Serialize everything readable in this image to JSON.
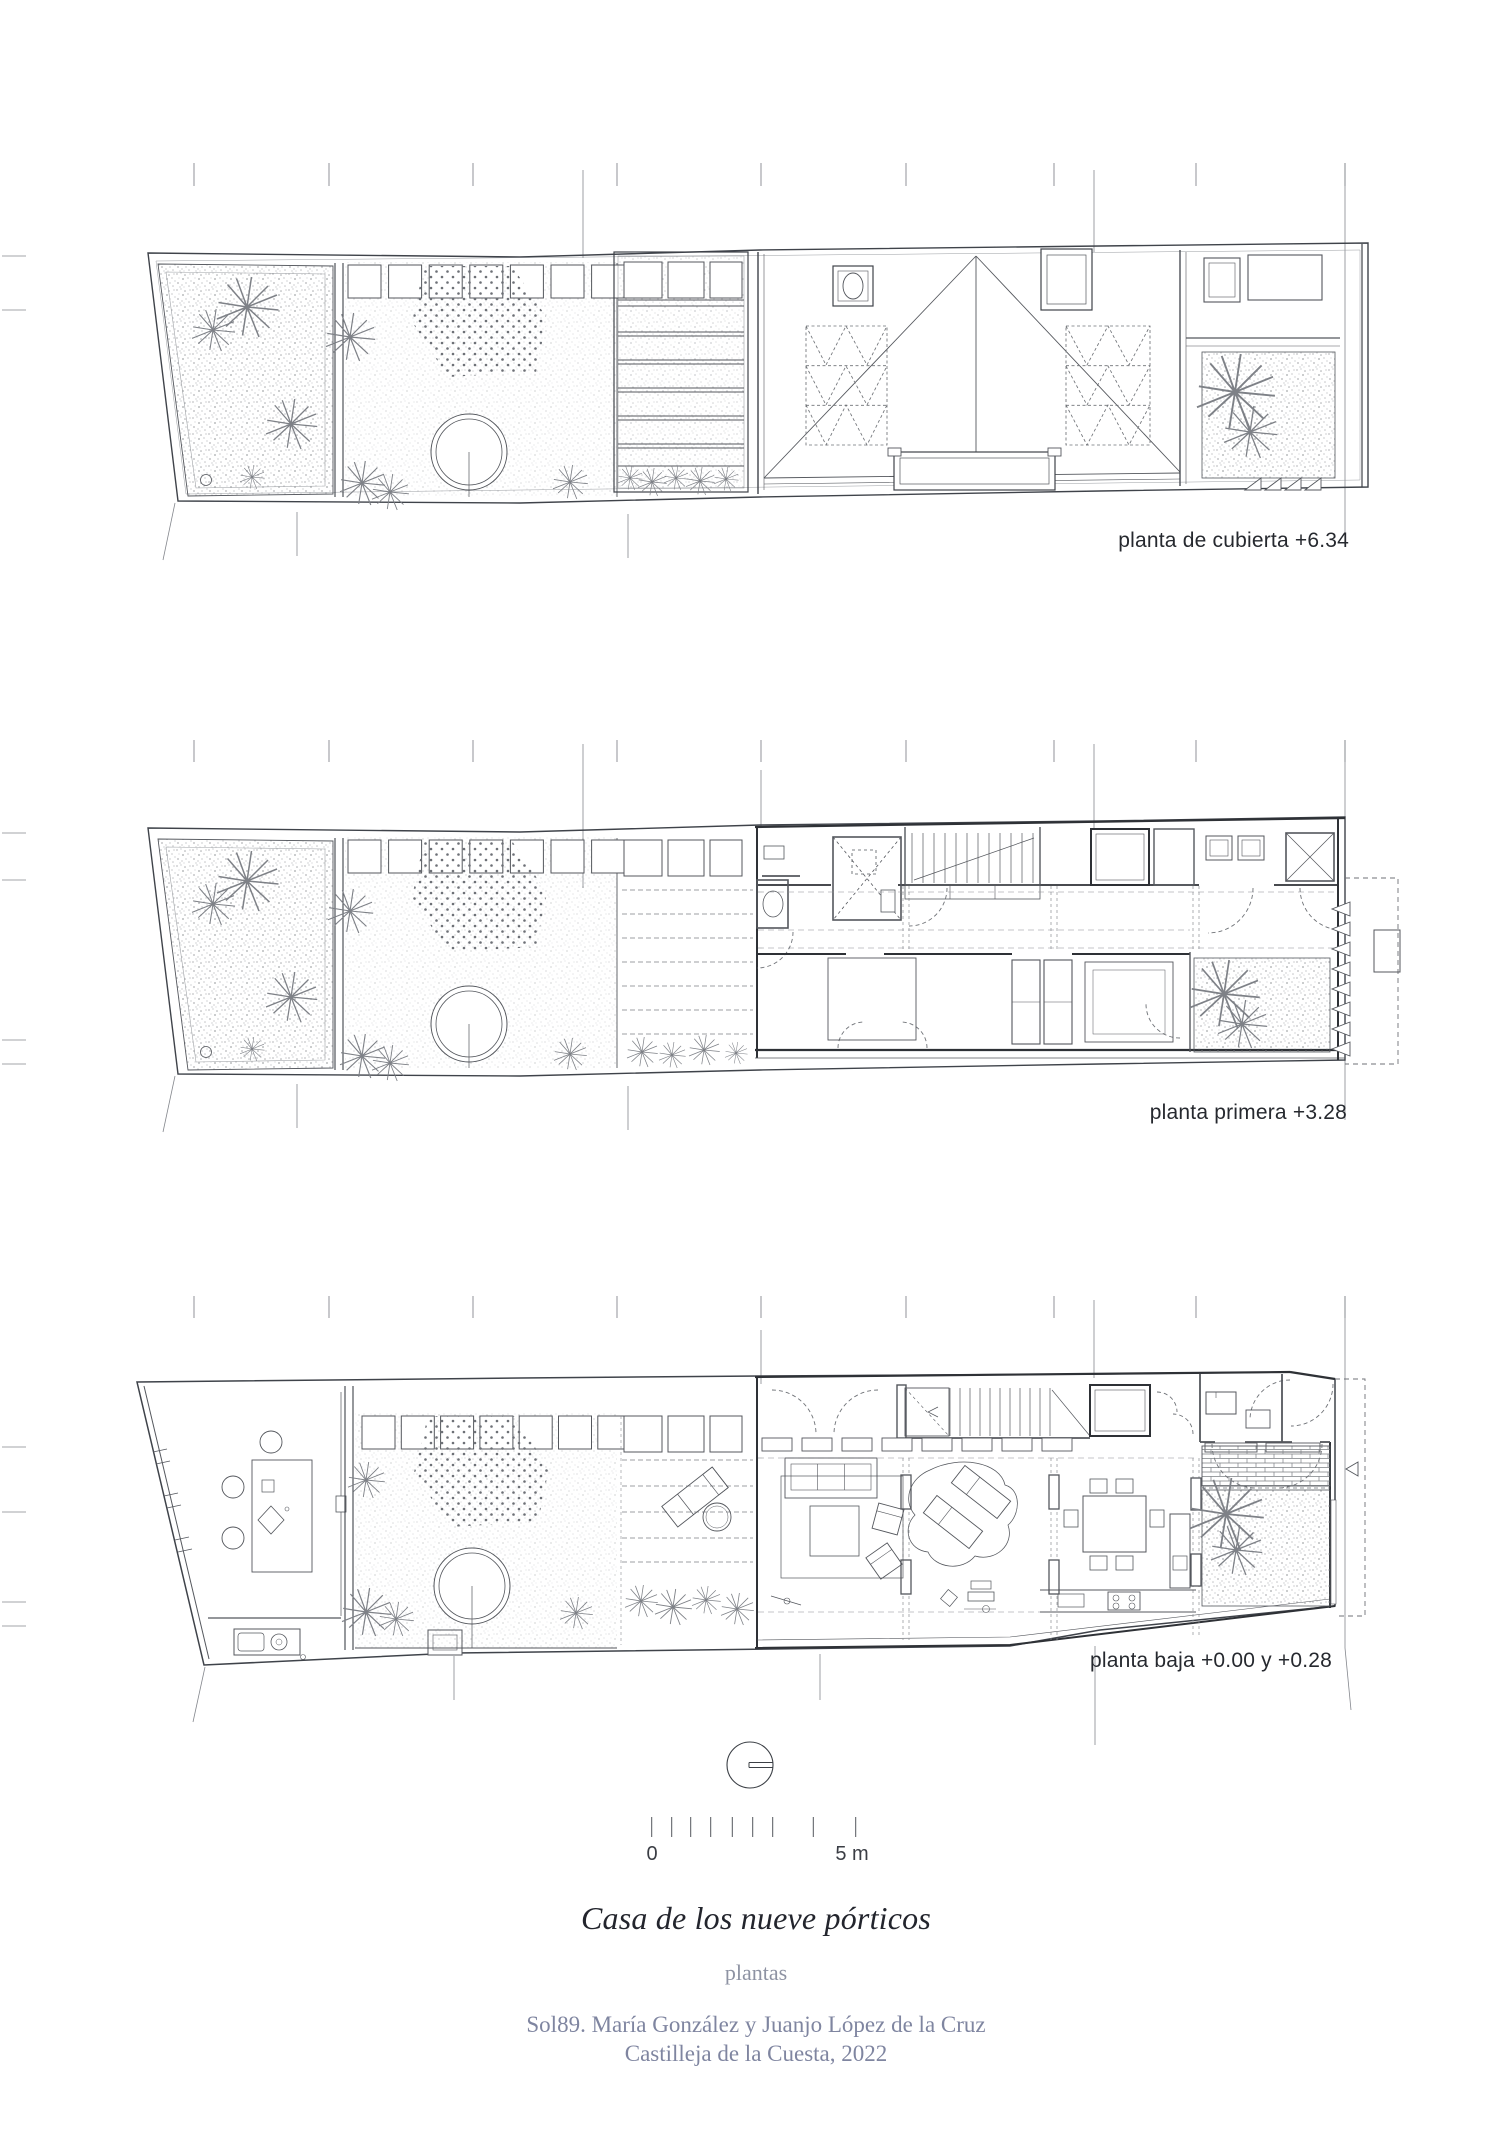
{
  "sheet": {
    "plans": [
      {
        "name": "planta de cubierta",
        "level": "+6.34",
        "label": "planta de cubierta +6.34"
      },
      {
        "name": "planta primera",
        "level": "+3.28",
        "label": "planta primera +3.28"
      },
      {
        "name": "planta baja",
        "level": "+0.00 y +0.28",
        "label": "planta baja +0.00 y +0.28"
      }
    ],
    "scale_bar": {
      "start_label": "0",
      "end_label": "5 m",
      "tick_values_m": [
        0,
        0.5,
        1,
        1.5,
        2,
        2.5,
        3,
        4,
        5
      ]
    },
    "north_indicator": "circle with horizontal pointer",
    "title_block": {
      "title": "Casa de los nueve pórticos",
      "subtitle": "plantas",
      "credit_line_1": "Sol89. María González y Juanjo López de la Cruz",
      "credit_line_2": "Castilleja de la Cuesta, 2022"
    },
    "colors": {
      "ink": "#54575d",
      "wall": "#2e3136",
      "muted_text": "#7f85a0",
      "dark_text": "#24262e"
    }
  }
}
